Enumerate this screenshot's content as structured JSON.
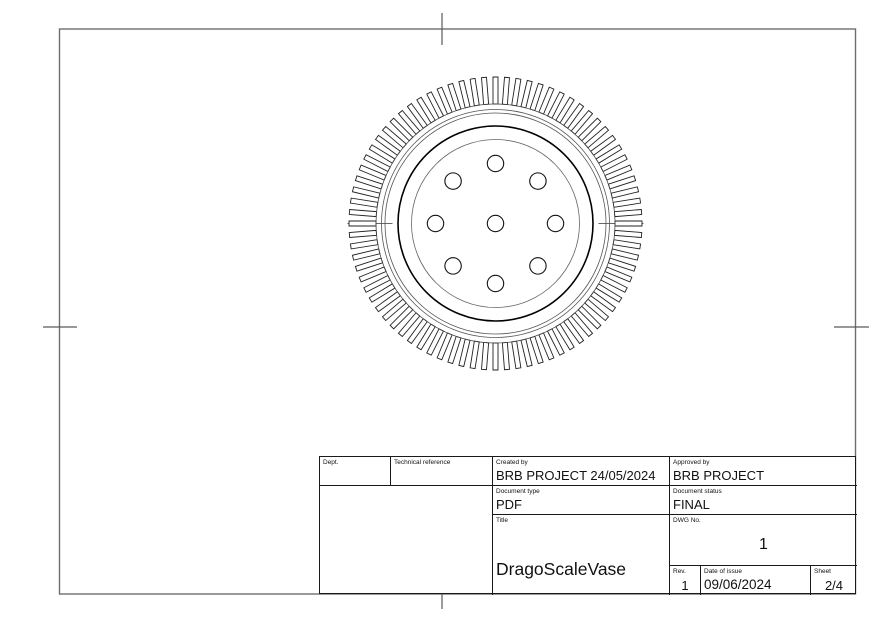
{
  "page": {
    "width": 885,
    "height": 625,
    "background": "#ffffff"
  },
  "title_block": {
    "dept": {
      "label": "Dept.",
      "value": ""
    },
    "technical_reference": {
      "label": "Technical reference",
      "value": ""
    },
    "created_by": {
      "label": "Created by",
      "value": "BRB PROJECT 24/05/2024"
    },
    "approved_by": {
      "label": "Approved by",
      "value": "BRB PROJECT"
    },
    "document_type": {
      "label": "Document type",
      "value": "PDF"
    },
    "document_status": {
      "label": "Document status",
      "value": "FINAL"
    },
    "title": {
      "label": "Title",
      "value": "DragoScaleVase"
    },
    "dwg_no": {
      "label": "DWG No.",
      "value": "1"
    },
    "rev": {
      "label": "Rev.",
      "value": "1"
    },
    "date_of_issue": {
      "label": "Date of issue",
      "value": "09/06/2024"
    },
    "sheet": {
      "label": "Sheet",
      "value": "2/4"
    }
  },
  "frame": {
    "x": 59.5,
    "y": 29,
    "width": 796,
    "height": 565,
    "color": "#6e6e6e",
    "stroke_width": 1.4,
    "marks_color": "#5a5a5a",
    "centering_marks": [
      {
        "x1": 442,
        "y1": 13,
        "x2": 442,
        "y2": 45
      },
      {
        "x1": 442,
        "y1": 577,
        "x2": 442,
        "y2": 609
      },
      {
        "x1": 43,
        "y1": 327,
        "x2": 77,
        "y2": 327
      },
      {
        "x1": 834,
        "y1": 327,
        "x2": 869,
        "y2": 327
      }
    ]
  },
  "drawing": {
    "cx": 495.5,
    "cy": 223.5,
    "fins": {
      "count": 80,
      "r_inner": 119.5,
      "r_outer": 146.5,
      "width": 5,
      "stroke": "#222222",
      "stroke_width": 0.9
    },
    "circles": [
      {
        "r": 119.5,
        "stroke": "#444444",
        "width": 0.8
      },
      {
        "r": 114.0,
        "stroke": "#555555",
        "width": 0.8
      },
      {
        "r": 110.5,
        "stroke": "#555555",
        "width": 0.8
      },
      {
        "r": 97.5,
        "stroke": "#000000",
        "width": 1.6
      },
      {
        "r": 84.0,
        "stroke": "#666666",
        "width": 0.8
      }
    ],
    "holes": {
      "pattern_radius": 60,
      "radius": 8.2,
      "count": 8,
      "start_angle_deg": -90,
      "center_hole": true,
      "stroke": "#111111",
      "width": 1.1
    },
    "center_ticks": {
      "r_outer": 148,
      "r_inner": 103,
      "stroke": "#333333",
      "width": 0.8
    }
  }
}
